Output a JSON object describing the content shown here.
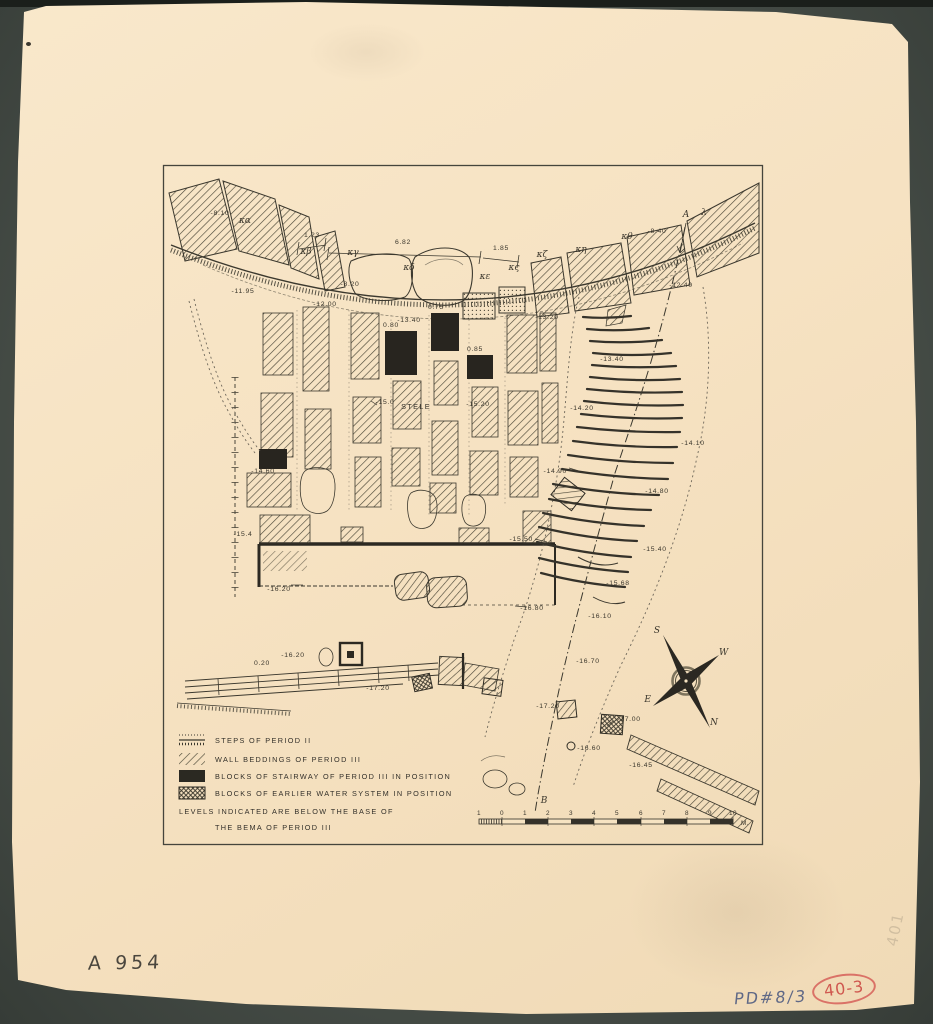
{
  "annotations": {
    "catalog_number": "A 954",
    "ref_number": "PD#8/3",
    "red_stamp": "40-3",
    "faint_pencil": "401"
  },
  "colors": {
    "paper": "#f6e3c4",
    "background": "#4d544e",
    "ink": "#35322a",
    "stamp_red": "#cc4a44",
    "pencil_blue": "#46557e"
  },
  "map": {
    "greek": [
      "κα",
      "κβ",
      "κγ",
      "κδ",
      "κε",
      "κς",
      "κζ",
      "κη",
      "κθ",
      "λ"
    ],
    "points": {
      "a": "A",
      "b": "B",
      "stele": "STELE"
    },
    "dimensions": [
      "1.23",
      "6.82",
      "1.85"
    ],
    "elevations": [
      "-8.10",
      "-11.95",
      "-8.20",
      "-12.00",
      "-13.40",
      "-13.20",
      "-12.40",
      "-8.40",
      "-13.40",
      "-14.20",
      "-14.10",
      "-14.90",
      "-14.80",
      "-14.60",
      "-15.0",
      "-15.20",
      "0.80",
      "0.75",
      "0.85",
      "-15.4",
      "-15.50",
      "-15.40",
      "-15.68",
      "-16.10",
      "-16.70",
      "-16.20",
      "-16.80",
      "0.20",
      "-16.20",
      "-17.20",
      "-17.20",
      "-17.00",
      "-16.60",
      "-16.45"
    ],
    "legend": {
      "items": [
        {
          "symbol": "steps",
          "label": "STEPS OF PERIOD II"
        },
        {
          "symbol": "hatch",
          "label": "WALL BEDDINGS OF PERIOD III"
        },
        {
          "symbol": "solid-black",
          "label": "BLOCKS OF STAIRWAY OF PERIOD III IN POSITION"
        },
        {
          "symbol": "crosshatch",
          "label": "BLOCKS OF EARLIER WATER SYSTEM IN POSITION"
        }
      ],
      "note_line1": "LEVELS INDICATED ARE BELOW THE BASE OF",
      "note_line2": "THE  BEMA  OF  PERIOD  III"
    },
    "compass": {
      "s": "S",
      "w": "W",
      "e": "E",
      "n": "N"
    },
    "scale_bar": {
      "ticks": [
        "1",
        "0",
        "1",
        "2",
        "3",
        "4",
        "5",
        "6",
        "7",
        "8",
        "9",
        "10"
      ],
      "unit": "M."
    }
  }
}
